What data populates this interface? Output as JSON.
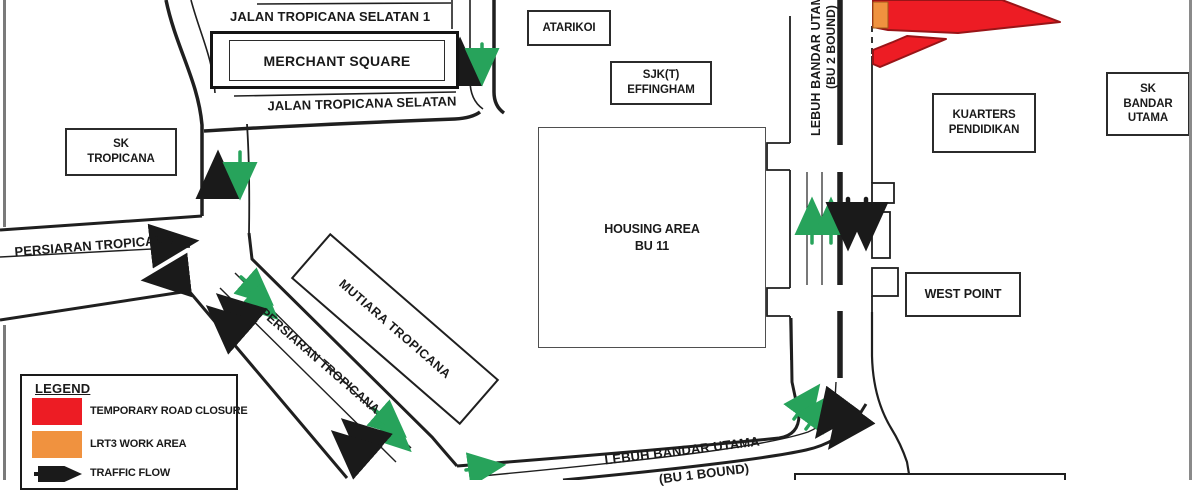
{
  "map": {
    "title": "LRT3 traffic diversion map",
    "roads": {
      "jalan_tropicana_selatan_1": "JALAN TROPICANA SELATAN 1",
      "jalan_tropicana_selatan": "JALAN TROPICANA SELATAN",
      "persiaran_tropicana_west": "PERSIARAN TROPICANA",
      "persiaran_tropicana_diagonal": "PERSIARAN TROPICANA",
      "lebuh_bandar_utama_bu2": {
        "name": "LEBUH BANDAR UTAMA",
        "bound": "(BU 2 BOUND)"
      },
      "lebuh_bandar_utama_bu1": {
        "name": "LEBUH BANDAR UTAMA",
        "bound": "(BU 1 BOUND)"
      }
    },
    "places": {
      "merchant_square": "MERCHANT SQUARE",
      "sk_tropicana": "SK\nTROPICANA",
      "atarikoi": "ATARIKOI",
      "sjkt_effingham": "SJK(T)\nEFFINGHAM",
      "housing_area_bu11": "HOUSING AREA\nBU 11",
      "mutiara_tropicana": "MUTIARA TROPICANA",
      "kuarters_pendidikan": "KUARTERS\nPENDIDIKAN",
      "sk_bandar_utama": "SK\nBANDAR\nUTAMA",
      "west_point": "WEST POINT"
    },
    "legend": {
      "title": "LEGEND",
      "items": [
        {
          "id": "closure",
          "label": "TEMPORARY ROAD CLOSURE",
          "swatch": "#ed1c24"
        },
        {
          "id": "work_area",
          "label": "LRT3 WORK AREA",
          "swatch": "#f0923f"
        },
        {
          "id": "flow",
          "label": "TRAFFIC FLOW",
          "swatch": "black-arrow"
        }
      ]
    },
    "colors": {
      "closure_red": "#ed1c24",
      "closure_outline": "#991417",
      "work_orange": "#f0923f",
      "flow_black": "#1a1a1a",
      "flow_green": "#27a35b",
      "road_line": "#1f1f1f",
      "page_border_gray": "#8a8a8a"
    }
  }
}
